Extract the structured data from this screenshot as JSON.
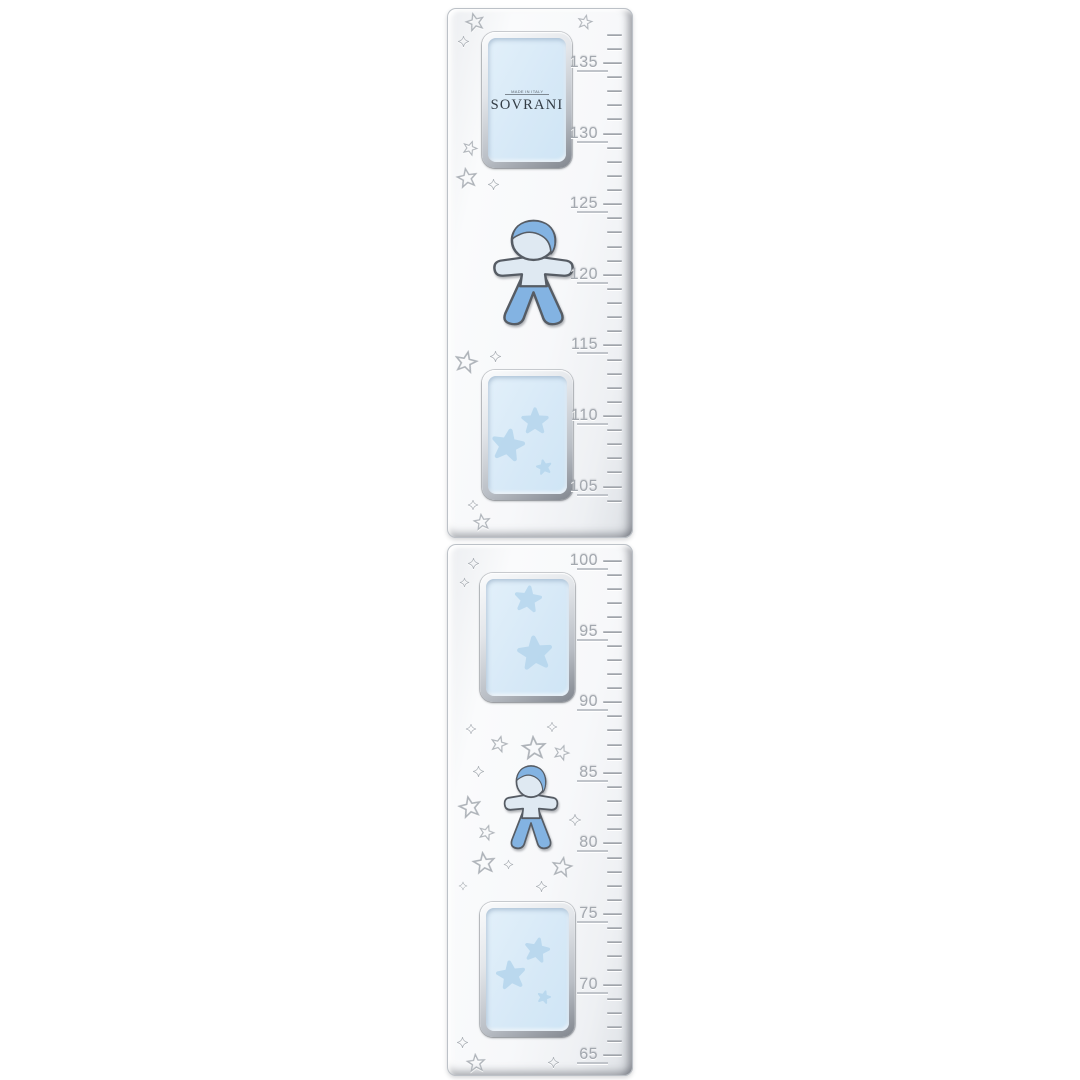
{
  "brand": {
    "name": "SOVRANI",
    "origin": "MADE IN ITALY"
  },
  "ruler": {
    "unit": "cm",
    "upper_labels": [
      "135",
      "130",
      "125",
      "120",
      "115",
      "110",
      "105"
    ],
    "lower_labels": [
      "100",
      "95",
      "90",
      "85",
      "80",
      "75",
      "70",
      "65"
    ]
  },
  "decor": {
    "boy_figure": "baby-boy silhouette with light blue head and arms, blue hair and legs",
    "engraved_star": "outlined five-point star engraving",
    "sparkle_star": "four-point twinkle engraving",
    "insert_star": "soft blue filled star on photo window",
    "colors": {
      "background": "#ffffff",
      "panel_silver": "#f4f6f8",
      "panel_edge": "#7e838b",
      "insert_blue": "#d7e9f7",
      "insert_star_blue": "#b7d7ee",
      "boy_light": "#dfe9f2",
      "boy_blue": "#83b3e2",
      "engraving_gray": "#aeb3b9",
      "label_gray": "#a3a8af"
    }
  }
}
